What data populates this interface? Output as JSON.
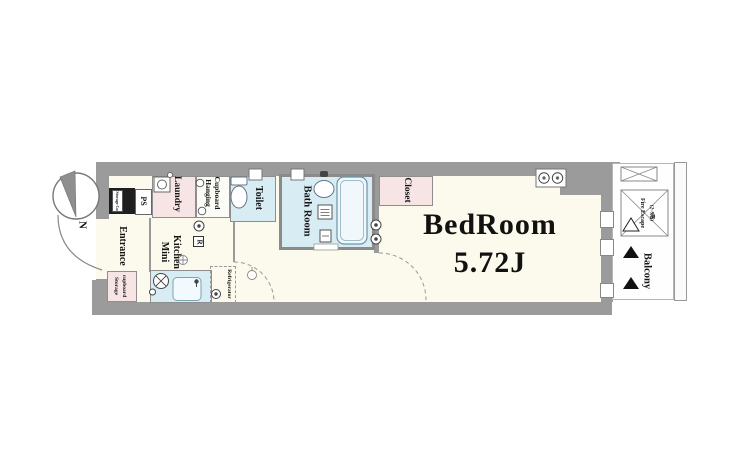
{
  "floorplan": {
    "compass": {
      "north_label": "N"
    },
    "bedroom": {
      "name": "BedRoom",
      "size": "5.72J"
    },
    "labels": {
      "entrance": "Entrance",
      "mini_kitchen": [
        "Mini",
        "Kitchen"
      ],
      "laundry": "Laundry",
      "hanging_cupboard": [
        "Hanging",
        "Cupboard"
      ],
      "toilet": "Toilet",
      "bath_room": "Bath Room",
      "closet": "Closet",
      "storage_cupboard": [
        "Storage",
        "cupboard"
      ],
      "shaft_storage": "Storage Cu",
      "pipe_space": "PS",
      "refrigerator": "Refrigerator",
      "refrigerator_outlet": "R",
      "balcony": "Balcony",
      "fire_escape": [
        "Fire Escape",
        "(2~9階)"
      ]
    },
    "colors": {
      "wall": "#9b9b9b",
      "floor_cream": "#fbfaec",
      "wet_area_blue": "#d8ecf4",
      "storage_pink": "#f7e4e4",
      "shaft_black": "#1f1f1f"
    },
    "icons": {
      "compass_needle": "north-needle-wedge",
      "entrance_door": "door-swing-arc",
      "washing_machine": "square-with-circle",
      "toilet_bowl": "tank-and-bowl",
      "bathtub": "rounded-tub",
      "washbasin": "oval-basin",
      "stove": "crossed-burner-circle",
      "fire_escape_hatch": "x-hatch-box",
      "balcony_markers": "triangles"
    }
  }
}
